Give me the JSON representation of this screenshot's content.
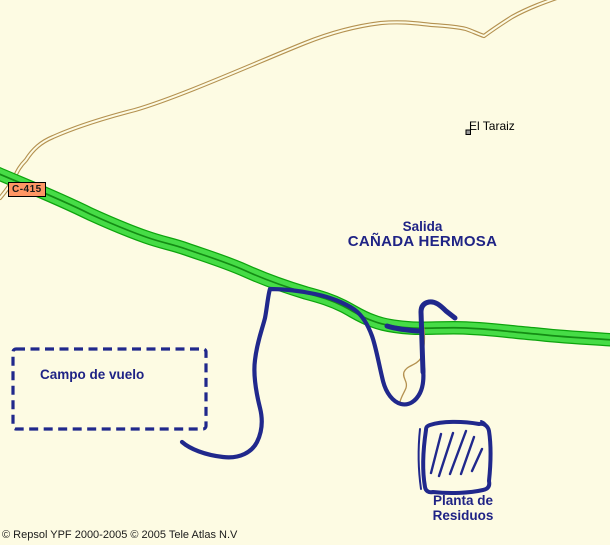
{
  "map": {
    "labels": {
      "road_shield": "C-415",
      "place": "El Taraiz",
      "exit_line1": "Salida",
      "exit_line2": "CAÑADA HERMOSA",
      "area": "Campo de vuelo",
      "poi_line1": "Planta de",
      "poi_line2": "Residuos"
    },
    "attribution": "© Repsol YPF 2000-2005 © 2005 Tele Atlas N.V",
    "colors": {
      "background": "#FDFBE3",
      "highway_fill": "#46DC46",
      "highway_edge": "#0DA30D",
      "highway_centerline": "#148C14",
      "minor_road": "#B49150",
      "overlay_navy": "#20288C",
      "label_navy": "#1F2385",
      "shield_fill": "#FF9664",
      "marker_gray": "#9A9A9A",
      "attribution_text": "#1A1A1A"
    }
  }
}
